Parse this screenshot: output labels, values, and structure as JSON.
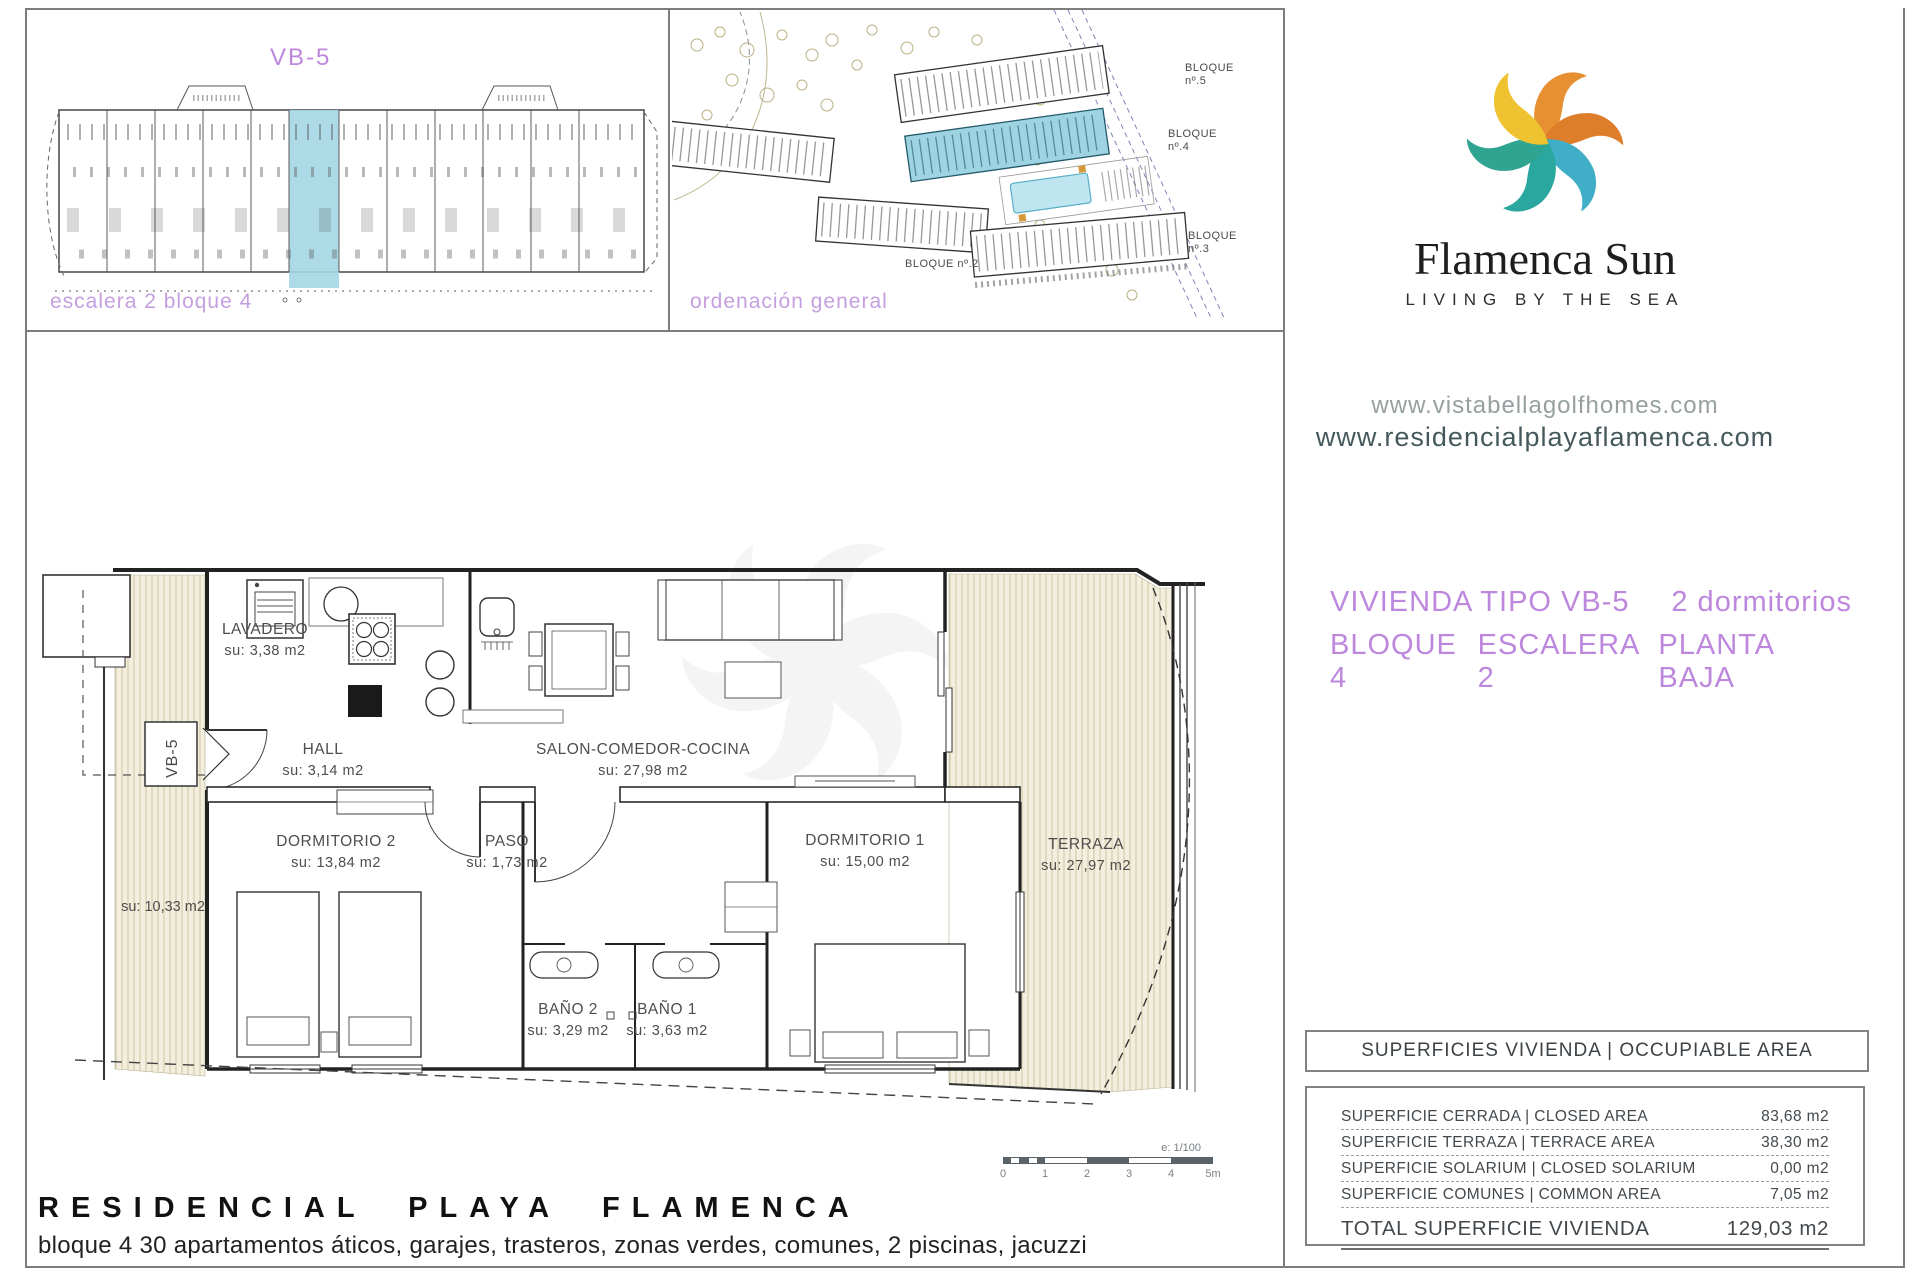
{
  "panel_block": {
    "title": "VB-5",
    "caption": "escalera 2 bloque 4"
  },
  "panel_site": {
    "caption": "ordenación general",
    "labels": [
      "BLOQUE\nnº.5",
      "BLOQUE\nnº.4",
      "BLOQUE\nnº.3",
      "BLOQUE nº.2"
    ]
  },
  "brand": {
    "name": "Flamenca Sun",
    "tagline": "LIVING BY THE SEA",
    "url_primary": "www.vistabellagolfhomes.com",
    "url_secondary": "www.residencialplayaflamenca.com"
  },
  "unit_header": {
    "type": "VIVIENDA TIPO VB-5",
    "bedrooms": "2 dormitorios",
    "block": "BLOQUE 4",
    "stair": "ESCALERA 2",
    "floor": "PLANTA BAJA"
  },
  "floorplan": {
    "tag": "VB-5",
    "rooms": [
      {
        "name": "LAVADERO",
        "su": "su: 3,38 m2"
      },
      {
        "name": "HALL",
        "su": "su: 3,14 m2"
      },
      {
        "name": "SALON-COMEDOR-COCINA",
        "su": "su: 27,98 m2"
      },
      {
        "name": "DORMITORIO 2",
        "su": "su: 13,84 m2"
      },
      {
        "name": "PASO",
        "su": "su: 1,73 m2"
      },
      {
        "name": "DORMITORIO 1",
        "su": "su: 15,00 m2"
      },
      {
        "name": "BAÑO 2",
        "su": "su: 3,29 m2"
      },
      {
        "name": "BAÑO 1",
        "su": "su: 3,63 m2"
      },
      {
        "name": "TERRAZA",
        "su": "su: 27,97 m2"
      }
    ],
    "side_terrace_su": "su: 10,33 m2",
    "scalebar": {
      "scale": "e: 1/100",
      "ticks": [
        "0",
        "1",
        "2",
        "3",
        "4",
        "5m"
      ]
    }
  },
  "surfaces_table": {
    "header": "SUPERFICIES VIVIENDA  |  OCCUPIABLE AREA",
    "rows": [
      {
        "label": "SUPERFICIE CERRADA  |  CLOSED AREA",
        "value": "83,68 m2"
      },
      {
        "label": "SUPERFICIE TERRAZA   |  TERRACE AREA",
        "value": "38,30 m2"
      },
      {
        "label": "SUPERFICIE SOLARIUM  |  CLOSED SOLARIUM",
        "value": "0,00 m2"
      },
      {
        "label": "SUPERFICIE COMUNES  |  COMMON AREA",
        "value": "7,05 m2"
      }
    ],
    "total": {
      "label": "TOTAL SUPERFICIE VIVIENDA",
      "value": "129,03 m2"
    }
  },
  "footer": {
    "title": "RESIDENCIAL PLAYA FLAMENCA",
    "subtitle": "bloque 4 30 apartamentos áticos, garajes, trasteros, zonas verdes, comunes, 2 piscinas, jacuzzi"
  },
  "colors": {
    "accent_purple": "#bd87dd",
    "caption_purple": "#c59fe0",
    "highlight_cyan": "#a3d6e3",
    "logo_orange": "#e79033",
    "logo_orange_deep": "#de7e2b",
    "logo_yellow": "#eec230",
    "logo_cyan": "#3faec6",
    "logo_teal": "#2aa79e",
    "logo_green": "#2fa491",
    "url_primary_gray": "#96a0a0",
    "url_secondary_dark": "#45595c"
  }
}
